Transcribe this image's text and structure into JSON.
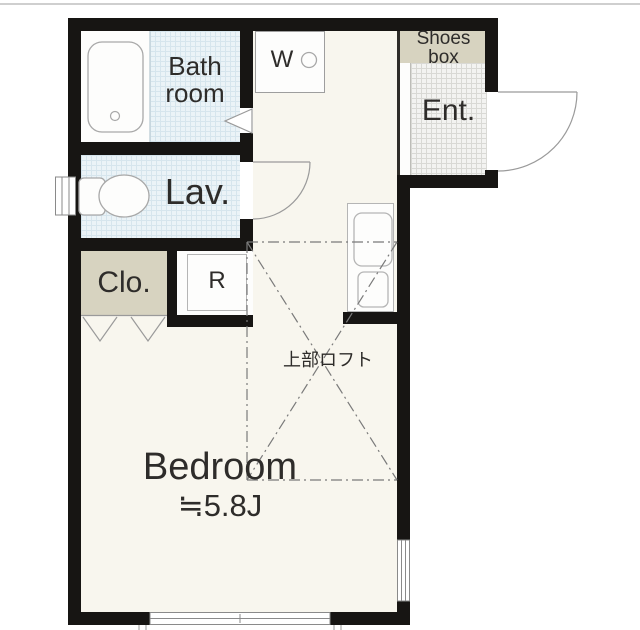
{
  "plan_title": "1R apartment floor plan",
  "rooms": {
    "bathroom": {
      "label_line1": "Bath",
      "label_line2": "room"
    },
    "lavatory": {
      "label": "Lav."
    },
    "closet": {
      "label": "Clo."
    },
    "refrigerator": {
      "label": "R"
    },
    "washer": {
      "label": "W"
    },
    "shoes_box": {
      "label_line1": "Shoes",
      "label_line2": "box"
    },
    "entrance": {
      "label": "Ent."
    },
    "loft": {
      "label": "上部ロフト"
    },
    "bedroom": {
      "label": "Bedroom",
      "size": "≒5.8J"
    }
  },
  "fixtures": [
    "bathtub",
    "toilet",
    "washing-machine-pan",
    "kitchen-sink",
    "stove",
    "closet-folding-door",
    "entrance-door-swing",
    "lavatory-door-swing",
    "bathroom-door-mark",
    "sliding-window-bottom",
    "window-right",
    "window-left"
  ],
  "colors": {
    "wall": "#171513",
    "floor_cream": "#f8f6ee",
    "tile_blue": "#ebf3f7",
    "tile_blue_grid": "#d6e5ed",
    "entrance_tile": "#f3f3f1",
    "entrance_tile_grid": "#d9d9d5",
    "storage_beige": "#d7d3c0",
    "fixture_stroke": "#a8a8a8",
    "loft_dash": "#7a7a7a",
    "text": "#2e2c2a"
  }
}
